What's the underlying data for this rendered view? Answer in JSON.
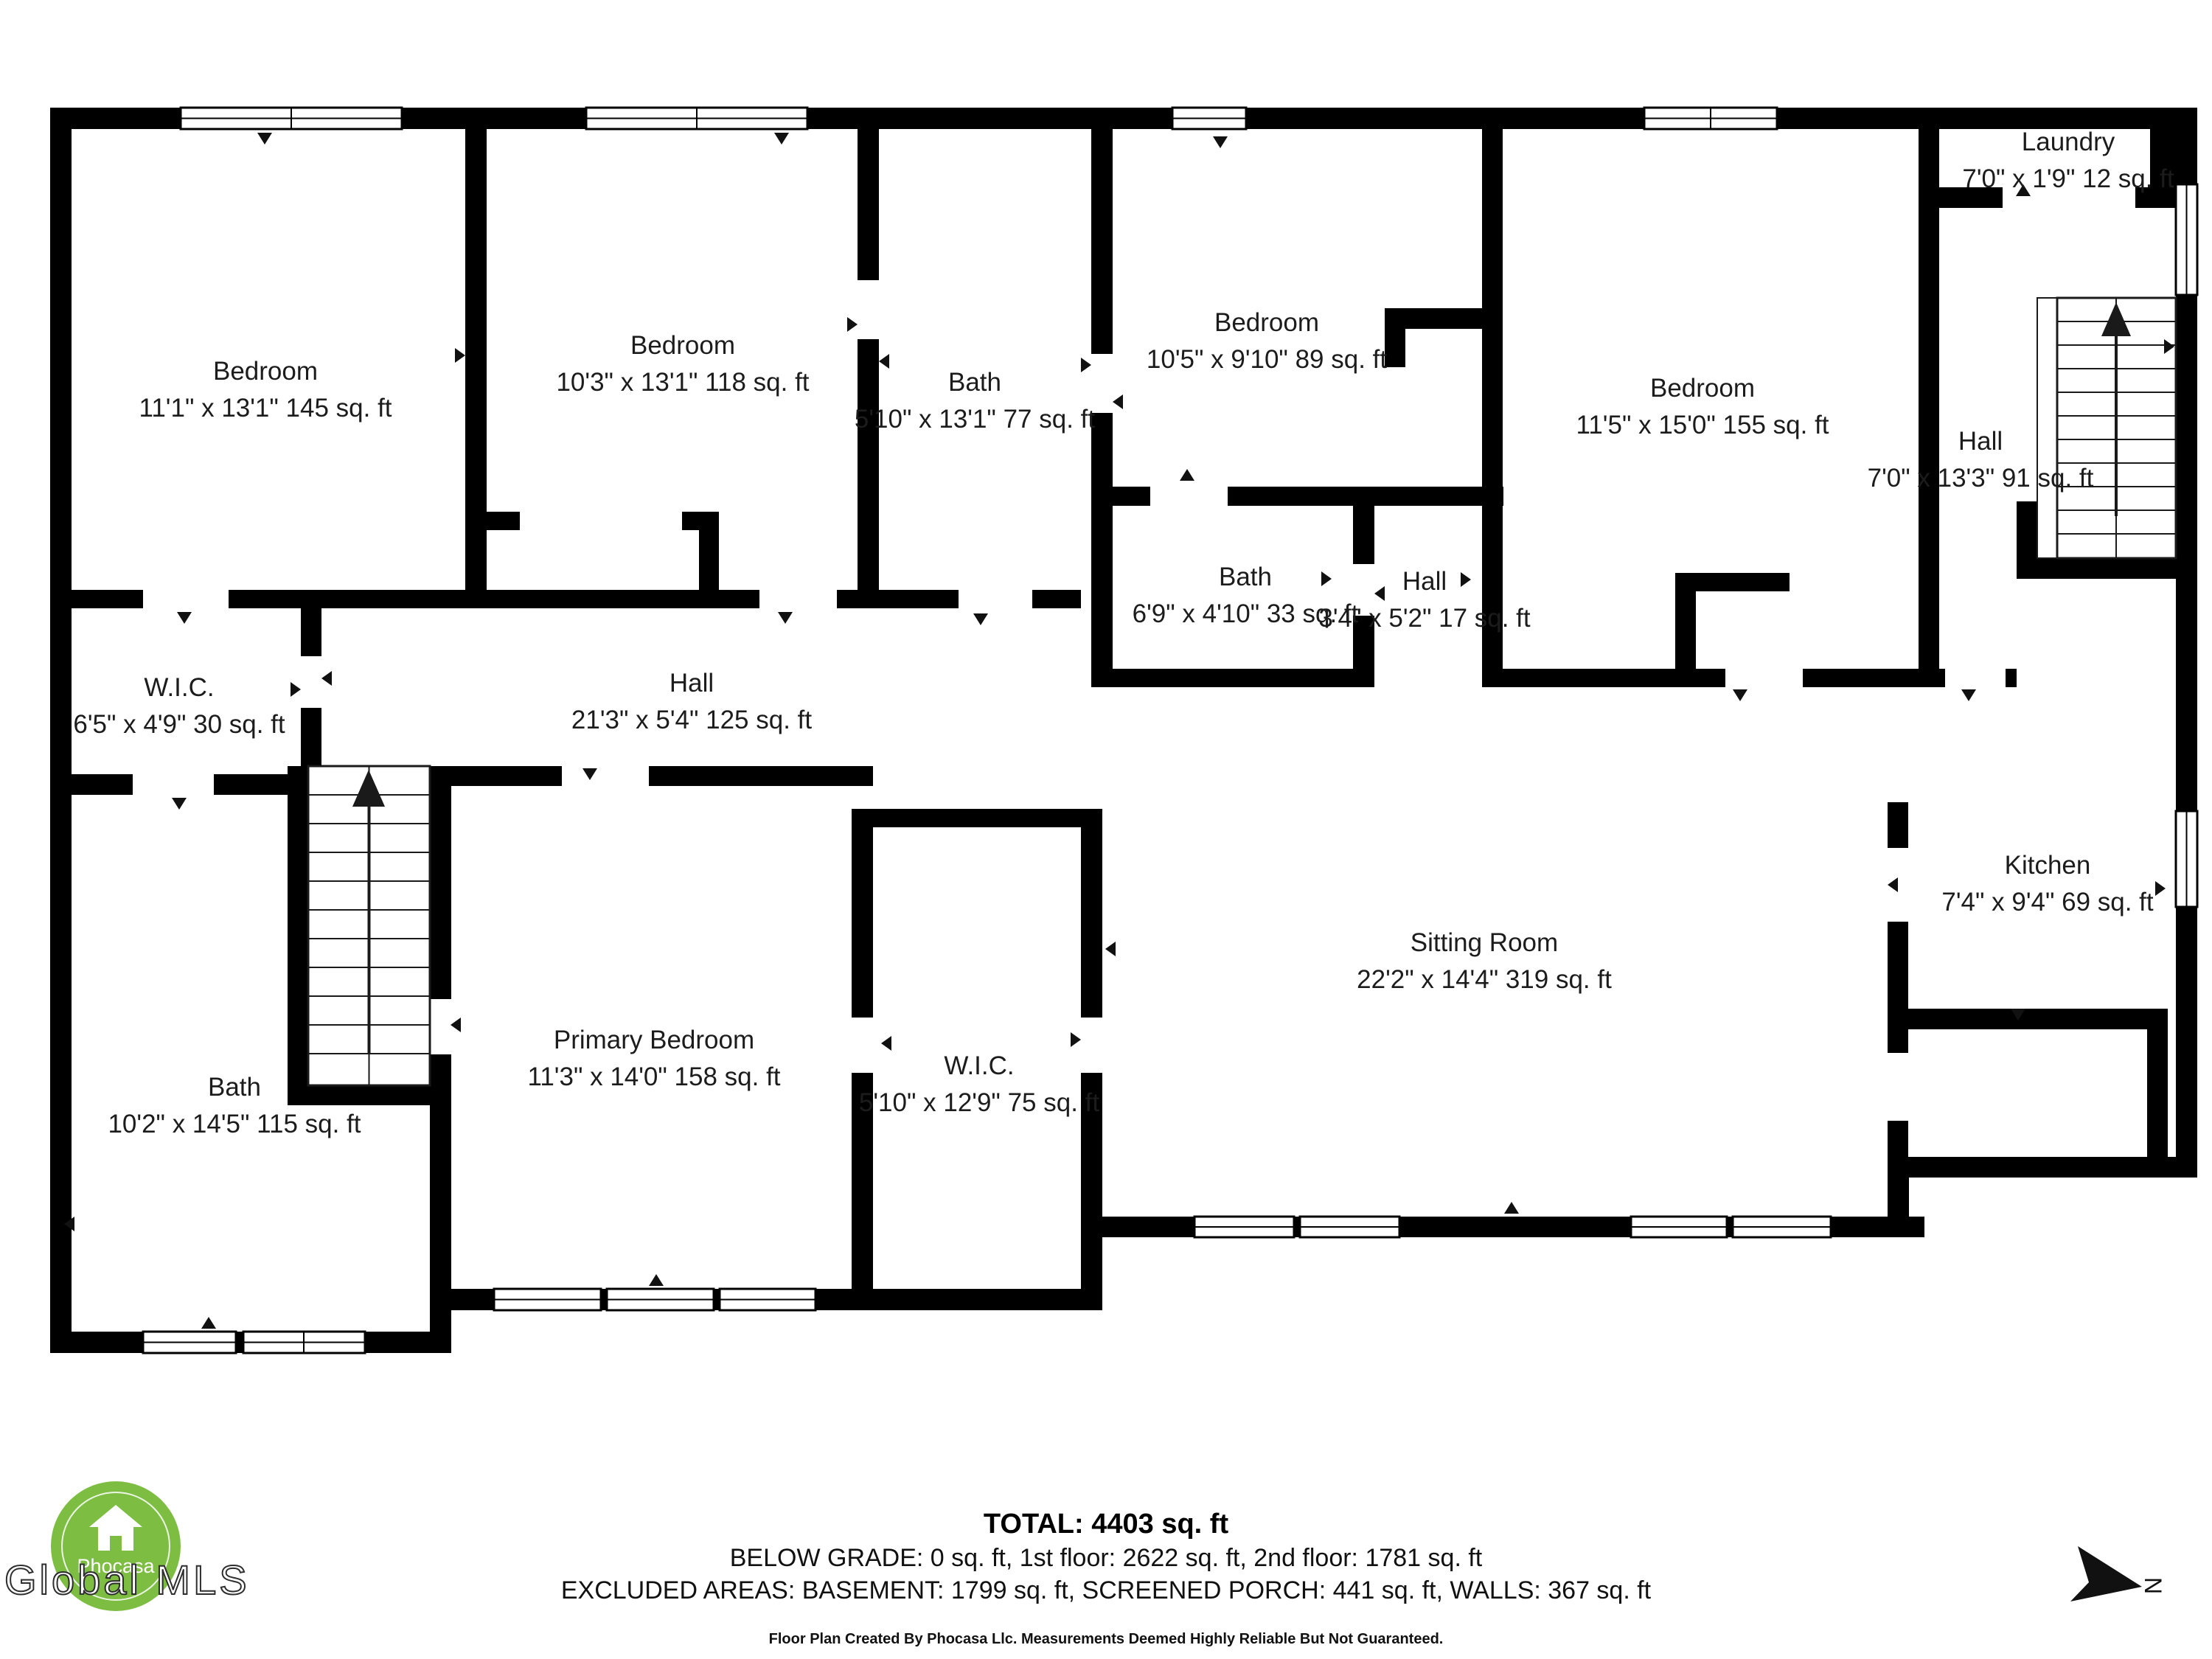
{
  "rooms": [
    {
      "id": "bedroom-1",
      "name": "Bedroom",
      "dims": "11'1\" x 13'1\" 145 sq. ft"
    },
    {
      "id": "bedroom-2",
      "name": "Bedroom",
      "dims": "10'3\" x 13'1\" 118 sq. ft"
    },
    {
      "id": "bath-top",
      "name": "Bath",
      "dims": "5'10\" x 13'1\" 77 sq. ft"
    },
    {
      "id": "bedroom-3",
      "name": "Bedroom",
      "dims": "10'5\" x 9'10\" 89 sq. ft"
    },
    {
      "id": "bedroom-4",
      "name": "Bedroom",
      "dims": "11'5\" x 15'0\" 155 sq. ft"
    },
    {
      "id": "laundry",
      "name": "Laundry",
      "dims": "7'0\" x 1'9\" 12 sq. ft"
    },
    {
      "id": "hall-right",
      "name": "Hall",
      "dims": "7'0\" x 13'3\" 91 sq. ft"
    },
    {
      "id": "bath-middle",
      "name": "Bath",
      "dims": "6'9\" x 4'10\" 33 sq. ft"
    },
    {
      "id": "hall-small",
      "name": "Hall",
      "dims": "3'4\" x 5'2\" 17 sq. ft"
    },
    {
      "id": "wic-1",
      "name": "W.I.C.",
      "dims": "6'5\" x 4'9\" 30 sq. ft"
    },
    {
      "id": "hall-center",
      "name": "Hall",
      "dims": "21'3\" x 5'4\" 125 sq. ft"
    },
    {
      "id": "bath-lower",
      "name": "Bath",
      "dims": "10'2\" x 14'5\" 115 sq. ft"
    },
    {
      "id": "primary-bedroom",
      "name": "Primary Bedroom",
      "dims": "11'3\" x 14'0\" 158 sq. ft"
    },
    {
      "id": "wic-2",
      "name": "W.I.C.",
      "dims": "5'10\" x 12'9\" 75 sq. ft"
    },
    {
      "id": "sitting-room",
      "name": "Sitting Room",
      "dims": "22'2\" x 14'4\" 319 sq. ft"
    },
    {
      "id": "kitchen",
      "name": "Kitchen",
      "dims": "7'4\" x 9'4\" 69 sq. ft"
    }
  ],
  "footer": {
    "total": "TOTAL: 4403 sq. ft",
    "line2": "BELOW GRADE: 0 sq. ft, 1st floor: 2622 sq. ft, 2nd floor: 1781 sq. ft",
    "line3": "EXCLUDED AREAS: BASEMENT: 1799 sq. ft, SCREENED PORCH: 441 sq. ft, WALLS: 367 sq. ft",
    "disclaimer": "Floor Plan Created By Phocasa Llc. Measurements Deemed Highly Reliable But Not Guaranteed."
  },
  "logo": {
    "brand": "Phocasa",
    "watermark": "Global MLS",
    "color": "#7cbd42"
  },
  "compass": {
    "label": "N"
  },
  "colors": {
    "wall": "#000000",
    "text": "#1c1c1c"
  }
}
